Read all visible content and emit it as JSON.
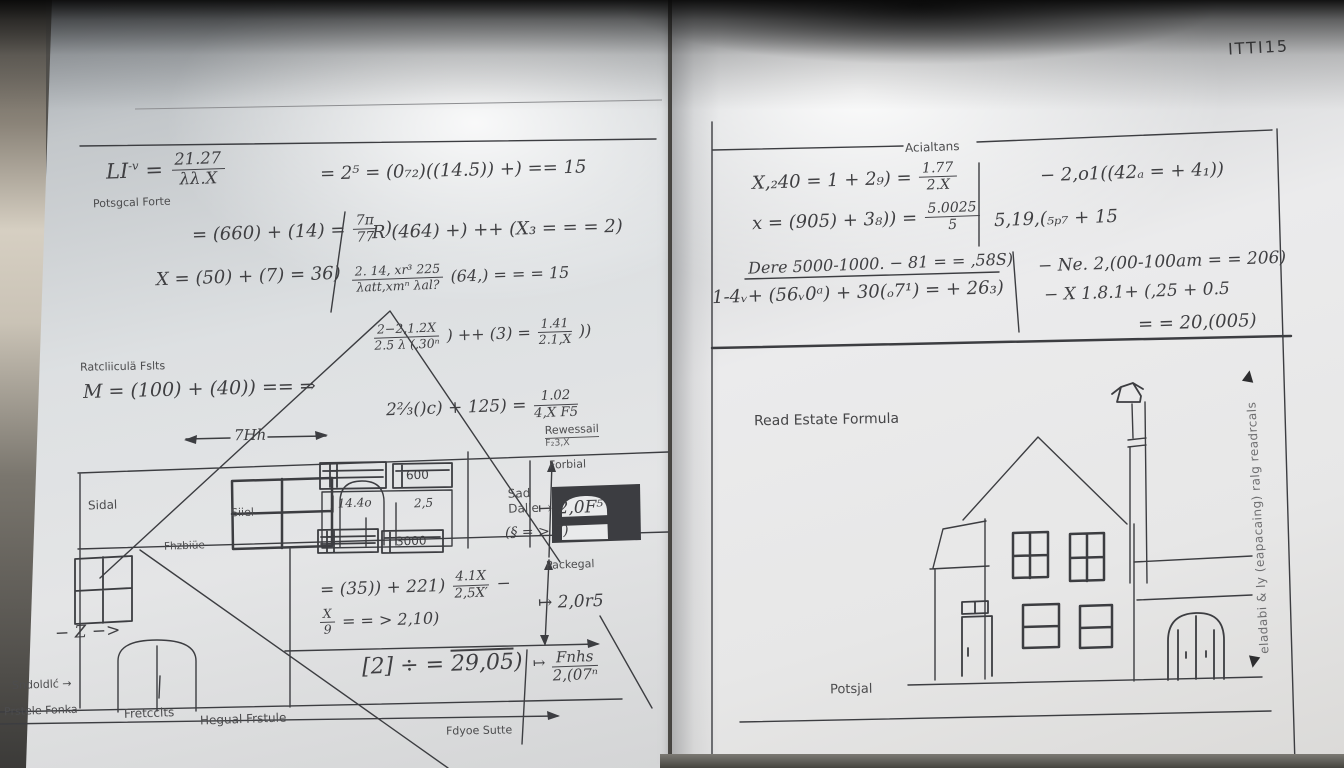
{
  "code": "ITTI15",
  "left": {
    "f_li_pre": "LI",
    "f_li_sup": "-v",
    "f_li_eq": "=",
    "f_li_num": "21.27",
    "f_li_den": "λλ.X",
    "potsgcal": "Potsgcal Forte",
    "f_eq15": "= 2⁵ = (0₇₂)((14.5)) +) == 15",
    "f_660_pre": "= (660) + (14) =",
    "f_660_num": "7π",
    "f_660_den": "77",
    "f_660_post": ")",
    "f_r464": "R (464) +) ++ (X₃ = = = 2)",
    "f_x50": "X = (50) + (7) = 36)",
    "f_214_num": "2. 14, xr³ 225",
    "f_214_den": "λatt,xmⁿ  λal?",
    "f_214_post": "(64,) = = = 15",
    "f_22_num": "2−2,1.2X",
    "f_22_den": "2.5 λ (,30ⁿ",
    "f_22_mid": ") ++ (3) =",
    "f_141_num": "1.41",
    "f_141_den": "2.1,X",
    "f_22_post": "))",
    "rat_falts": "Ratcliiculä Fslts",
    "f_m": "M = (100) + (40)) == ⇒",
    "dim_7hh": "7Hh",
    "f_23_pre": "2⅔()c) + 125) =",
    "f_23_num": "1.02",
    "f_23_den": "4,X F5",
    "rewessail": "Rewessail",
    "rewessail2": "F₂3,X",
    "forbial": "Forbial",
    "w600": "600",
    "v144": ", 14.4o",
    "v25": "2,5",
    "w3000": "3000",
    "sad1": "Sad",
    "sad2": "Dalle",
    "sad3": "(§ = > 7)",
    "f_20f": "↦ 2,0F⁵",
    "packegal": "Packegal",
    "f_35_pre": "= (35)) + 221)",
    "f_35_num": "4.1X",
    "f_35_den": "2,5X′",
    "f_35_post": "−",
    "f_20r": "↦ 2,0r5",
    "f_x9_num": "X",
    "f_x9_den": "9",
    "f_x9_post": "= = > 2,10)",
    "f_2_pre": "[2] ÷ =",
    "f_2_over": "29,05",
    "f_2_post": ")",
    "fnhs_arrow": "↦",
    "fnhs_num": "Fnhs",
    "fnhs_den": "2,(07ⁿ",
    "z_arrow": "− Z −>",
    "sndolic": "Sndoldlć →",
    "prstele": "Prstele Fonka",
    "fretcclts": "Fretcclts",
    "hegual": "Hegual Frstule",
    "fdyoe": "Fdyoe Sutte",
    "sidal": "Sidal",
    "siiel": "Siiel",
    "fhzbide": "Fhzbiüe"
  },
  "right": {
    "acialtans": "Acialtans",
    "f_x40_pre": "X,₂40 = 1 + 2₉) =",
    "f_x40_num": "1.77",
    "f_x40_den": "2.X",
    "f_x905_pre": "x = (905) + 3₈)) =",
    "f_x905_num": "5.0025",
    "f_x905_den": "5",
    "f_201": "− 2,o1((42ₐ = + 4₁))",
    "f_519": "5,19,(₅ₚ₇ + 15",
    "f_dere": "Dere 5000-1000. − 81 = = ,58S)",
    "f_14": "1-4ᵥ+ (56ᵥ0ᵃ) + 30(ₒ7¹) = + 26₃)",
    "f_ne": "− Ne. 2,(00-100am = = 206)",
    "f_x18": "− X 1.8.1+ (,25 + 0.5",
    "f_20005": "= = 20,(005)",
    "read_estate": "Read Estate Formula",
    "potsjal": "Potsjal",
    "side_text": "eladabi & ly (eapacaing) ralg readrcals",
    "up_arrow": "▲",
    "down_arrow": "▼"
  }
}
